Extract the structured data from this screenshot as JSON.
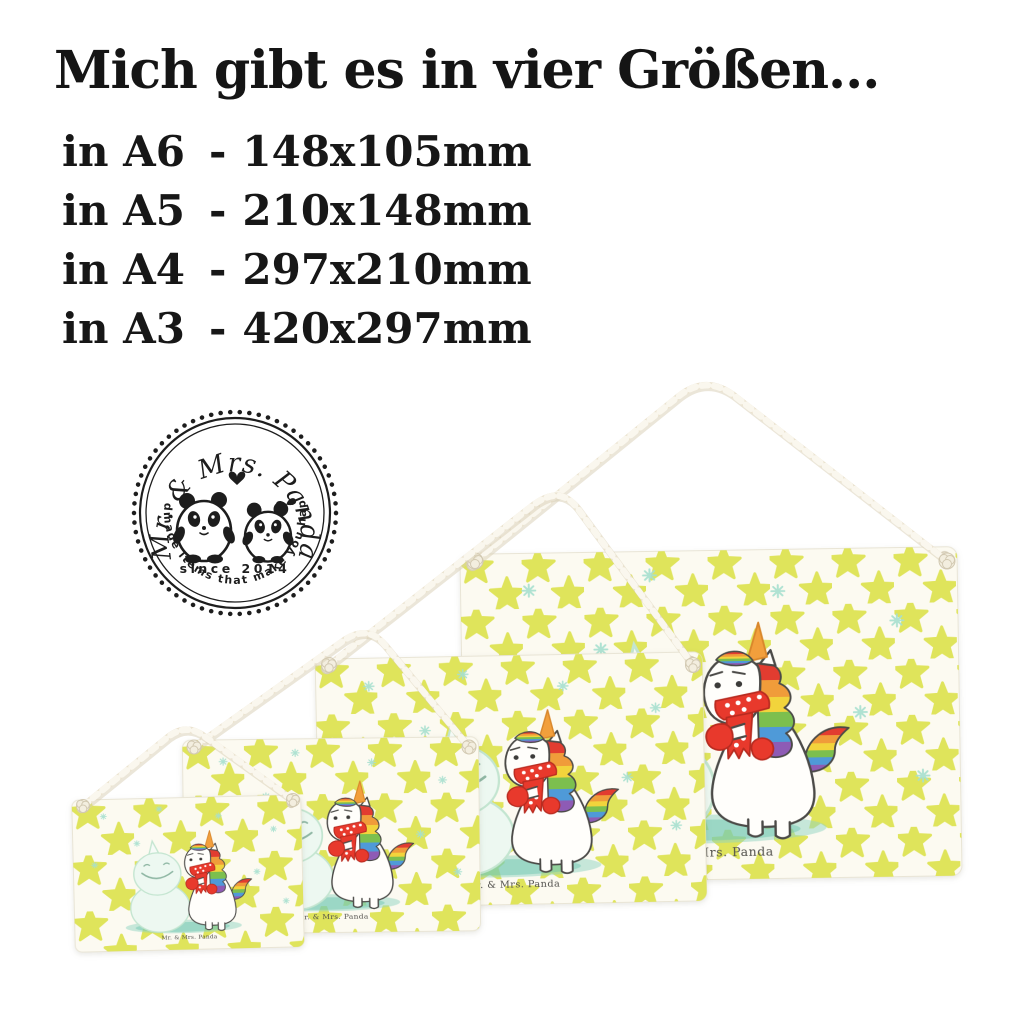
{
  "headline": "Mich gibt es in vier Größen...",
  "size_list": {
    "separator": "-",
    "items": [
      {
        "label": "in A6",
        "dimensions": "148x105mm"
      },
      {
        "label": "in A5",
        "dimensions": "210x148mm"
      },
      {
        "label": "in A4",
        "dimensions": "297x210mm"
      },
      {
        "label": "in A3",
        "dimensions": "420x297mm"
      }
    ]
  },
  "badge": {
    "brand": "Mr. & Mrs. Panda",
    "since": "since 2014",
    "tagline": "Handmade items that make you happy!"
  },
  "signs": {
    "watermark": "Mr. & Mrs. Panda",
    "count": 4,
    "order_front_to_back": [
      "A6",
      "A5",
      "A4",
      "A3"
    ]
  },
  "palette": {
    "star_yellow": "#dde24f",
    "sign_background": "#fcfaf1",
    "scarf_red": "#e8392c",
    "horn_orange": "#f29f3c",
    "puddle_teal": "#7fccba",
    "snowman_mint": "#edf8f1",
    "snowflake_teal": "#a7e0cf",
    "cord_cream": "#ebe3d0",
    "stamp_black": "#1d1d1d",
    "text_black": "#151515",
    "mane_rainbow": [
      "#e23c30",
      "#f09c3a",
      "#f2d43c",
      "#7cbf4e",
      "#4f9ad8",
      "#8e5bb5"
    ]
  }
}
